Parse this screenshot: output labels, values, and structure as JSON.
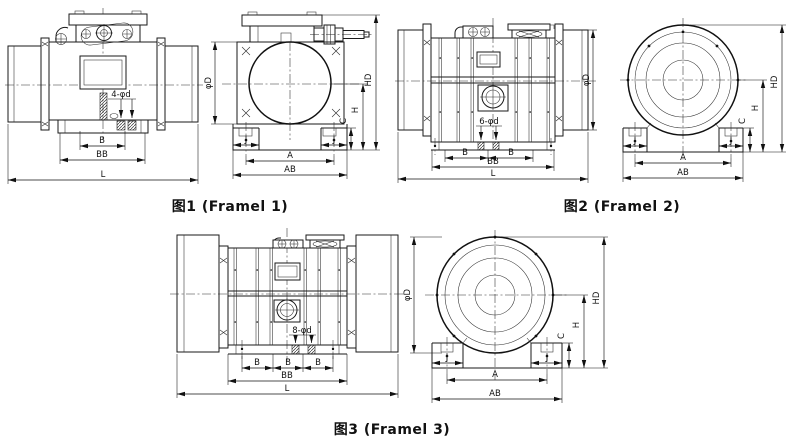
{
  "page": {
    "background": "#ffffff",
    "line_color": "#1a1a1a"
  },
  "figure1": {
    "caption": "图1 (Framel 1)",
    "side": {
      "holes": "4-φd",
      "b": "B",
      "bb": "BB",
      "l": "L"
    },
    "front": {
      "phi_d": "φD",
      "hd": "HD",
      "h": "H",
      "c": "C",
      "j_left": "J",
      "j_right": "J",
      "a": "A",
      "ab": "AB"
    }
  },
  "figure2": {
    "caption": "图2 (Framel 2)",
    "side": {
      "holes": "6-φd",
      "b1": "B",
      "b2": "B",
      "bb": "BB",
      "l": "L",
      "phi_d": "φD"
    },
    "front": {
      "hd": "HD",
      "h": "H",
      "c": "C",
      "j_left": "J",
      "j_right": "J",
      "a": "A",
      "ab": "AB"
    }
  },
  "figure3": {
    "caption": "图3 (Framel 3)",
    "side": {
      "holes": "8-φd",
      "b1": "B",
      "b2": "B",
      "b3": "B",
      "bb": "BB",
      "l": "L"
    },
    "front": {
      "phi_d": "φD",
      "hd": "HD",
      "h": "H",
      "c": "C",
      "j_left": "J",
      "j_right": "J",
      "a": "A",
      "ab": "AB"
    }
  }
}
